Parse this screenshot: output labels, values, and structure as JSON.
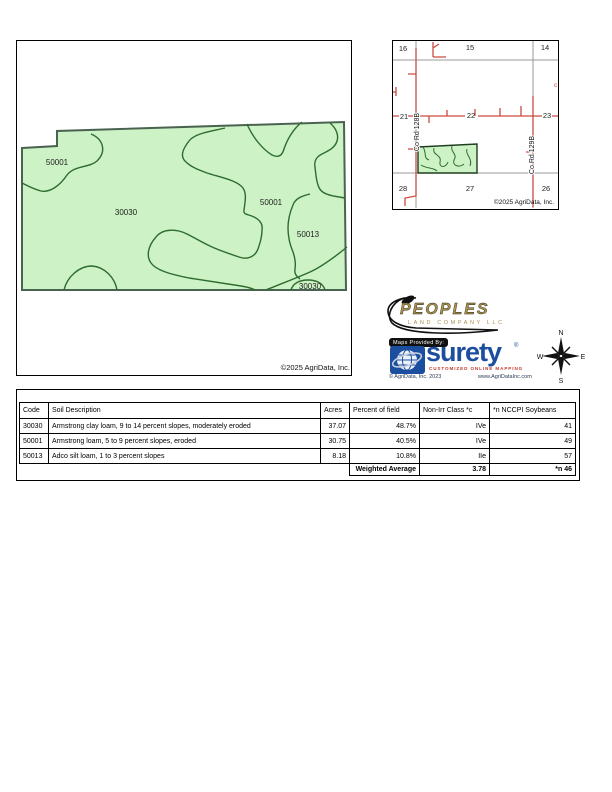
{
  "colors": {
    "field_fill": "#cdf2c5",
    "soil_line": "#2e6b2e",
    "map_border": "#4a6350",
    "road_red": "#cc4a42",
    "section_gray": "#999999",
    "peoples_gold": "#a8904f",
    "surety_blue": "#1b4e9f",
    "tagline_red": "#c03a2e"
  },
  "main_map": {
    "zone_labels": [
      {
        "text": "50001"
      },
      {
        "text": "30030"
      },
      {
        "text": "50001"
      },
      {
        "text": "50013"
      },
      {
        "text": "30030"
      }
    ],
    "copyright": "©2025 AgriData, Inc."
  },
  "locator_map": {
    "sections": [
      "16",
      "15",
      "14",
      "21",
      "22",
      "23",
      "28",
      "27",
      "26"
    ],
    "road_labels": [
      "Co Rd 128B",
      "Co Rd 129B"
    ],
    "edge_label": "c",
    "copyright": "©2025 AgriData, Inc."
  },
  "branding": {
    "peoples_name": "PEOPLES",
    "peoples_subtitle": "LAND COMPANY LLC",
    "maps_provided_by": "Maps Provided By:",
    "surety_name": "surety",
    "surety_registered": "®",
    "surety_tagline": "CUSTOMIZED ONLINE MAPPING",
    "surety_copyright": "© AgriData, Inc. 2023",
    "surety_website": "www.AgriDataInc.com"
  },
  "compass": {
    "n": "N",
    "e": "E",
    "s": "S",
    "w": "W"
  },
  "table": {
    "headers": [
      "Code",
      "Soil Description",
      "Acres",
      "Percent of field",
      "Non-Irr Class *c",
      "*n NCCPI Soybeans"
    ],
    "rows": [
      {
        "code": "30030",
        "description": "Armstrong clay loam, 9 to 14 percent slopes, moderately eroded",
        "acres": "37.07",
        "percent": "48.7%",
        "non_irr": "IVe",
        "nccpi": "41"
      },
      {
        "code": "50001",
        "description": "Armstrong loam, 5 to 9 percent slopes, eroded",
        "acres": "30.75",
        "percent": "40.5%",
        "non_irr": "IVe",
        "nccpi": "49"
      },
      {
        "code": "50013",
        "description": "Adco silt loam, 1 to 3 percent slopes",
        "acres": "8.18",
        "percent": "10.8%",
        "non_irr": "IIe",
        "nccpi": "57"
      }
    ],
    "weighted_average": {
      "label": "Weighted Average",
      "non_irr": "3.78",
      "nccpi": "*n 46"
    }
  }
}
